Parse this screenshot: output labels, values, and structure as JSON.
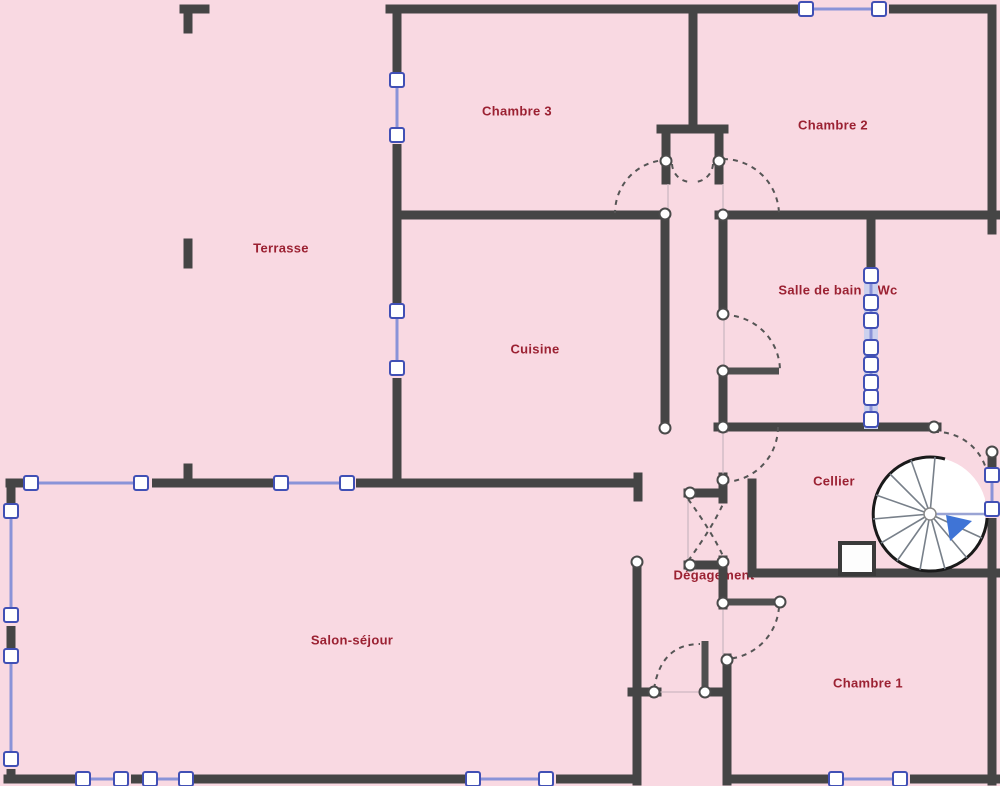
{
  "plan_title": "Floor plan",
  "rooms": {
    "terrasse": {
      "label": "Terrasse"
    },
    "chambre3": {
      "label": "Chambre 3"
    },
    "chambre2": {
      "label": "Chambre 2"
    },
    "cuisine": {
      "label": "Cuisine"
    },
    "salle_de_bain": {
      "label": "Salle de bain + Wc"
    },
    "cellier": {
      "label": "Cellier"
    },
    "degagement": {
      "label": "Dégagement"
    },
    "salon_sejour": {
      "label": "Salon-séjour"
    },
    "chambre1": {
      "label": "Chambre 1"
    }
  },
  "features": {
    "staircase": "spiral-staircase",
    "stair_direction_arrow": "blue-arrow"
  },
  "colors": {
    "background_pink": "#f9d9e2",
    "wall_gray": "#454545",
    "label_red": "#9b2132",
    "window_blue": "#8a93d8",
    "window_frame_blue": "#4150b5",
    "arrow_blue": "#3f74d6"
  }
}
